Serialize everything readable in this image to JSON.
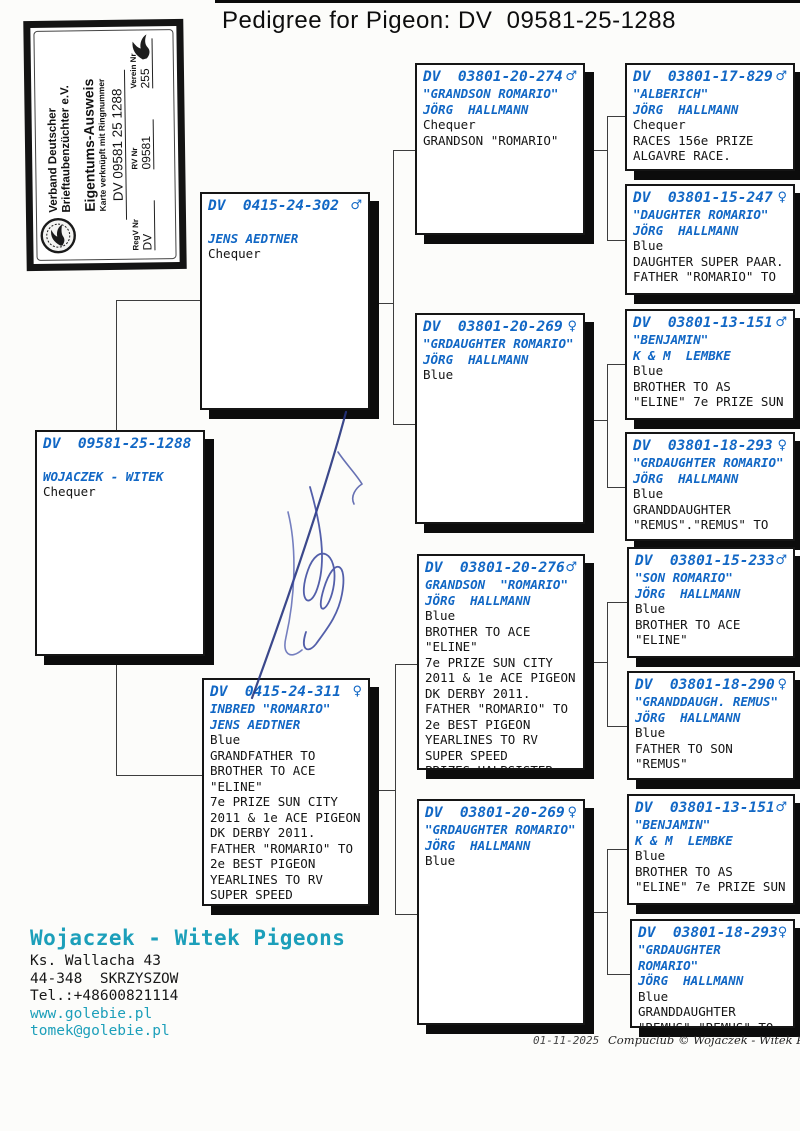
{
  "title": "Pedigree for Pigeon: DV  09581-25-1288",
  "colors": {
    "ring_blue": "#1167c5",
    "contact_teal": "#1c9fba"
  },
  "stamp": {
    "org": "Verband Deutscher\nBrieftaubenzüchter e.V.",
    "card_title": "Eigentums-Ausweis",
    "card_subtitle": "Karte verknüpft mit Ringnummer",
    "ring_number": "DV 09581 25 1288",
    "fields": [
      {
        "label": "RegV Nr",
        "value": "DV"
      },
      {
        "label": "RV Nr",
        "value": "09581"
      },
      {
        "label": "Verein Nr",
        "value": "255"
      }
    ]
  },
  "boxes": {
    "subject": {
      "ring": "DV  09581-25-1288",
      "sex": "",
      "blue": "\nWOJACZEK - WITEK",
      "black": "Chequer"
    },
    "father": {
      "ring": "DV  0415-24-302",
      "sex": "♂",
      "blue": "\nJENS AEDTNER",
      "black": "Chequer"
    },
    "mother": {
      "ring": "DV  0415-24-311",
      "sex": "♀",
      "blue": "INBRED \"ROMARIO\"\nJENS AEDTNER",
      "black": "Blue\nGRANDFATHER TO\nBROTHER TO ACE\n\"ELINE\"\n7e PRIZE SUN CITY\n2011 & 1e ACE PIGEON\nDK DERBY 2011.\nFATHER \"ROMARIO\" TO\n2e BEST PIGEON\nYEARLINES TO RV\nSUPER SPEED"
    },
    "gp1": {
      "ring": "DV  03801-20-274",
      "sex": "♂",
      "blue": "\"GRANDSON ROMARIO\"\nJÖRG  HALLMANN",
      "black": "Chequer\nGRANDSON \"ROMARIO\""
    },
    "gp2": {
      "ring": "DV  03801-20-269",
      "sex": "♀",
      "blue": "\"GRDAUGHTER ROMARIO\"\nJÖRG  HALLMANN",
      "black": "Blue"
    },
    "gp3": {
      "ring": "DV  03801-20-276",
      "sex": "♂",
      "blue": "GRANDSON  \"ROMARIO\"\nJÖRG  HALLMANN",
      "black": "Blue\nBROTHER TO ACE\n\"ELINE\"\n7e PRIZE SUN CITY\n2011 & 1e ACE PIGEON\nDK DERBY 2011.\nFATHER \"ROMARIO\" TO\n2e BEST PIGEON\nYEARLINES TO RV\nSUPER SPEED\nPRIZES.HALBSISTER"
    },
    "gp4": {
      "ring": "DV  03801-20-269",
      "sex": "♀",
      "blue": "\"GRDAUGHTER ROMARIO\"\nJÖRG  HALLMANN",
      "black": "Blue"
    },
    "ggp1": {
      "ring": "DV  03801-17-829",
      "sex": "♂",
      "blue": "\"ALBERICH\"\nJÖRG  HALLMANN",
      "black": "Chequer\nRACES 156e PRIZE\nALGAVRE RACE."
    },
    "ggp2": {
      "ring": "DV  03801-15-247",
      "sex": "♀",
      "blue": "\"DAUGHTER ROMARIO\"\nJÖRG  HALLMANN",
      "black": "Blue\nDAUGHTER SUPER PAAR.\nFATHER \"ROMARIO\" TO"
    },
    "ggp3": {
      "ring": "DV  03801-13-151",
      "sex": "♂",
      "blue": "\"BENJAMIN\"\nK & M  LEMBKE",
      "black": "Blue\nBROTHER TO AS\n\"ELINE\" 7e PRIZE SUN"
    },
    "ggp4": {
      "ring": "DV  03801-18-293",
      "sex": "♀",
      "blue": "\"GRDAUGHTER ROMARIO\"\nJÖRG  HALLMANN",
      "black": "Blue\nGRANDDAUGHTER\n\"REMUS\".\"REMUS\" TO"
    },
    "ggp5": {
      "ring": "DV  03801-15-233",
      "sex": "♂",
      "blue": "\"SON ROMARIO\"\nJÖRG  HALLMANN",
      "black": "Blue\nBROTHER TO ACE\n\"ELINE\""
    },
    "ggp6": {
      "ring": "DV  03801-18-290",
      "sex": "♀",
      "blue": "\"GRANDDAUGH. REMUS\"\nJÖRG  HALLMANN",
      "black": "Blue\nFATHER TO SON\n\"REMUS\""
    },
    "ggp7": {
      "ring": "DV  03801-13-151",
      "sex": "♂",
      "blue": "\"BENJAMIN\"\nK & M  LEMBKE",
      "black": "Blue\nBROTHER TO AS\n\"ELINE\" 7e PRIZE SUN"
    },
    "ggp8": {
      "ring": "DV  03801-18-293",
      "sex": "♀",
      "blue": "\"GRDAUGHTER ROMARIO\"\nJÖRG  HALLMANN",
      "black": "Blue\nGRANDDAUGHTER\n\"REMUS\",\"REMUS\" TO"
    }
  },
  "contact": {
    "name": "Wojaczek - Witek Pigeons",
    "address": "Ks. Wallacha 43\n44-348  SKRZYSZOW\nTel.:+48600821114",
    "links": "www.golebie.pl\ntomek@golebie.pl"
  },
  "footer": {
    "date": "01-11-2025",
    "copyright": "Compuclub © Wojaczek - Witek Pigeon"
  }
}
